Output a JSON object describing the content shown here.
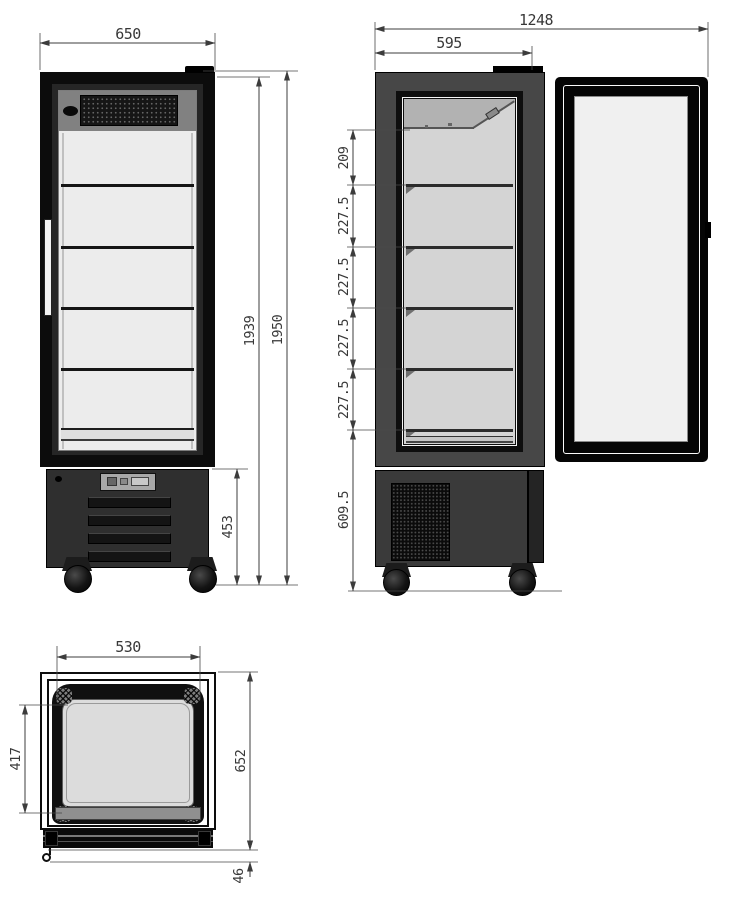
{
  "dims": {
    "front": {
      "width": "650",
      "body_height": "1939",
      "total_height": "1950",
      "base_height": "453"
    },
    "side": {
      "overall_depth": "1248",
      "cabinet_depth": "595",
      "seg_top": "209",
      "seg_2": "227.5",
      "seg_3": "227.5",
      "seg_4": "227.5",
      "seg_5": "227.5",
      "seg_base": "609.5"
    },
    "top": {
      "width": "530",
      "inner_depth": "417",
      "total_depth": "652",
      "door_offset": "46"
    }
  }
}
